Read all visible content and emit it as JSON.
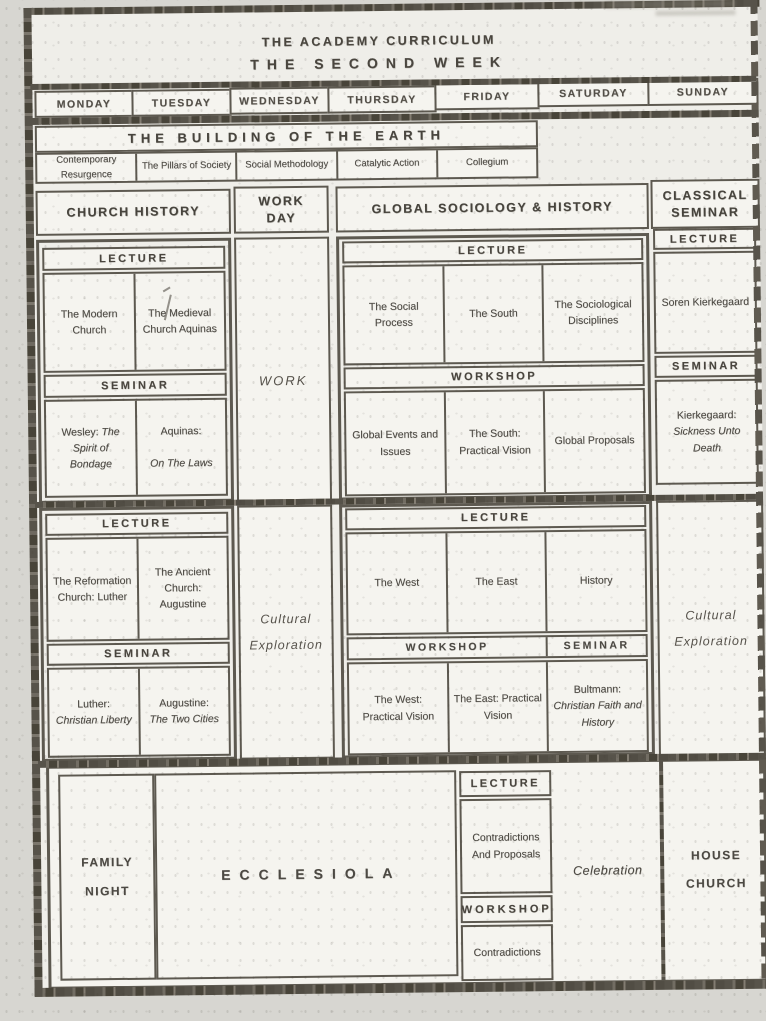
{
  "colors": {
    "paper": "#efeee9",
    "ink": "#4b4843",
    "rule": "#57534a"
  },
  "header": {
    "title": "THE ACADEMY CURRICULUM",
    "subtitle": "THE SECOND WEEK"
  },
  "days": [
    "MONDAY",
    "TUESDAY",
    "WEDNESDAY",
    "THURSDAY",
    "FRIDAY",
    "SATURDAY",
    "SUNDAY"
  ],
  "building": {
    "title": "THE BUILDING OF THE EARTH",
    "cells": [
      "Contemporary Resurgence",
      "The Pillars of Society",
      "Social Methodology",
      "Catalytic Action",
      "Collegium"
    ]
  },
  "section_headers": {
    "church_history": "CHURCH HISTORY",
    "work_day": "WORK DAY",
    "global": "GLOBAL SOCIOLOGY & HISTORY",
    "classical": "CLASSICAL SEMINAR"
  },
  "labels": {
    "lecture": "LECTURE",
    "seminar": "SEMINAR",
    "workshop": "WORKSHOP"
  },
  "church_am": {
    "lecture": [
      "The Modern Church",
      "The Medieval Church Aquinas"
    ],
    "seminar": [
      {
        "prefix": "Wesley:",
        "italic": "The Spirit of Bondage"
      },
      {
        "prefix": "Aquinas:",
        "italic": "On The Laws"
      }
    ]
  },
  "work_day": {
    "am": "WORK",
    "pm": "Cultural Exploration"
  },
  "global_am": {
    "lecture": [
      "The Social Process",
      "The South",
      "The Sociological Disciplines"
    ],
    "workshop": [
      "Global Events and Issues",
      "The South: Practical Vision",
      "Global Proposals"
    ]
  },
  "classical_am": {
    "lecture": "Soren Kierkegaard",
    "seminar": {
      "prefix": "Kierkegaard:",
      "italic": "Sickness Unto Death"
    }
  },
  "church_pm": {
    "lecture": [
      "The Reformation Church: Luther",
      "The Ancient Church: Augustine"
    ],
    "seminar": [
      {
        "prefix": "Luther:",
        "italic": "Christian Liberty"
      },
      {
        "prefix": "Augustine:",
        "italic": "The Two Cities"
      }
    ]
  },
  "global_pm": {
    "lecture": [
      "The West",
      "The East",
      "History"
    ],
    "workshop": [
      "The West: Practical Vision",
      "The East: Practical Vision"
    ],
    "seminar": {
      "prefix": "Bultmann:",
      "italic": "Christian Faith and History"
    }
  },
  "classical_pm": "Cultural Exploration",
  "evening": {
    "family_night": "FAMILY NIGHT",
    "ecclesiola": "ECCLESIOLA",
    "lecture_cell": "Contradictions And Proposals",
    "workshop_cell": "Contradictions",
    "celebration": "Celebration",
    "house_church": "HOUSE CHURCH"
  }
}
